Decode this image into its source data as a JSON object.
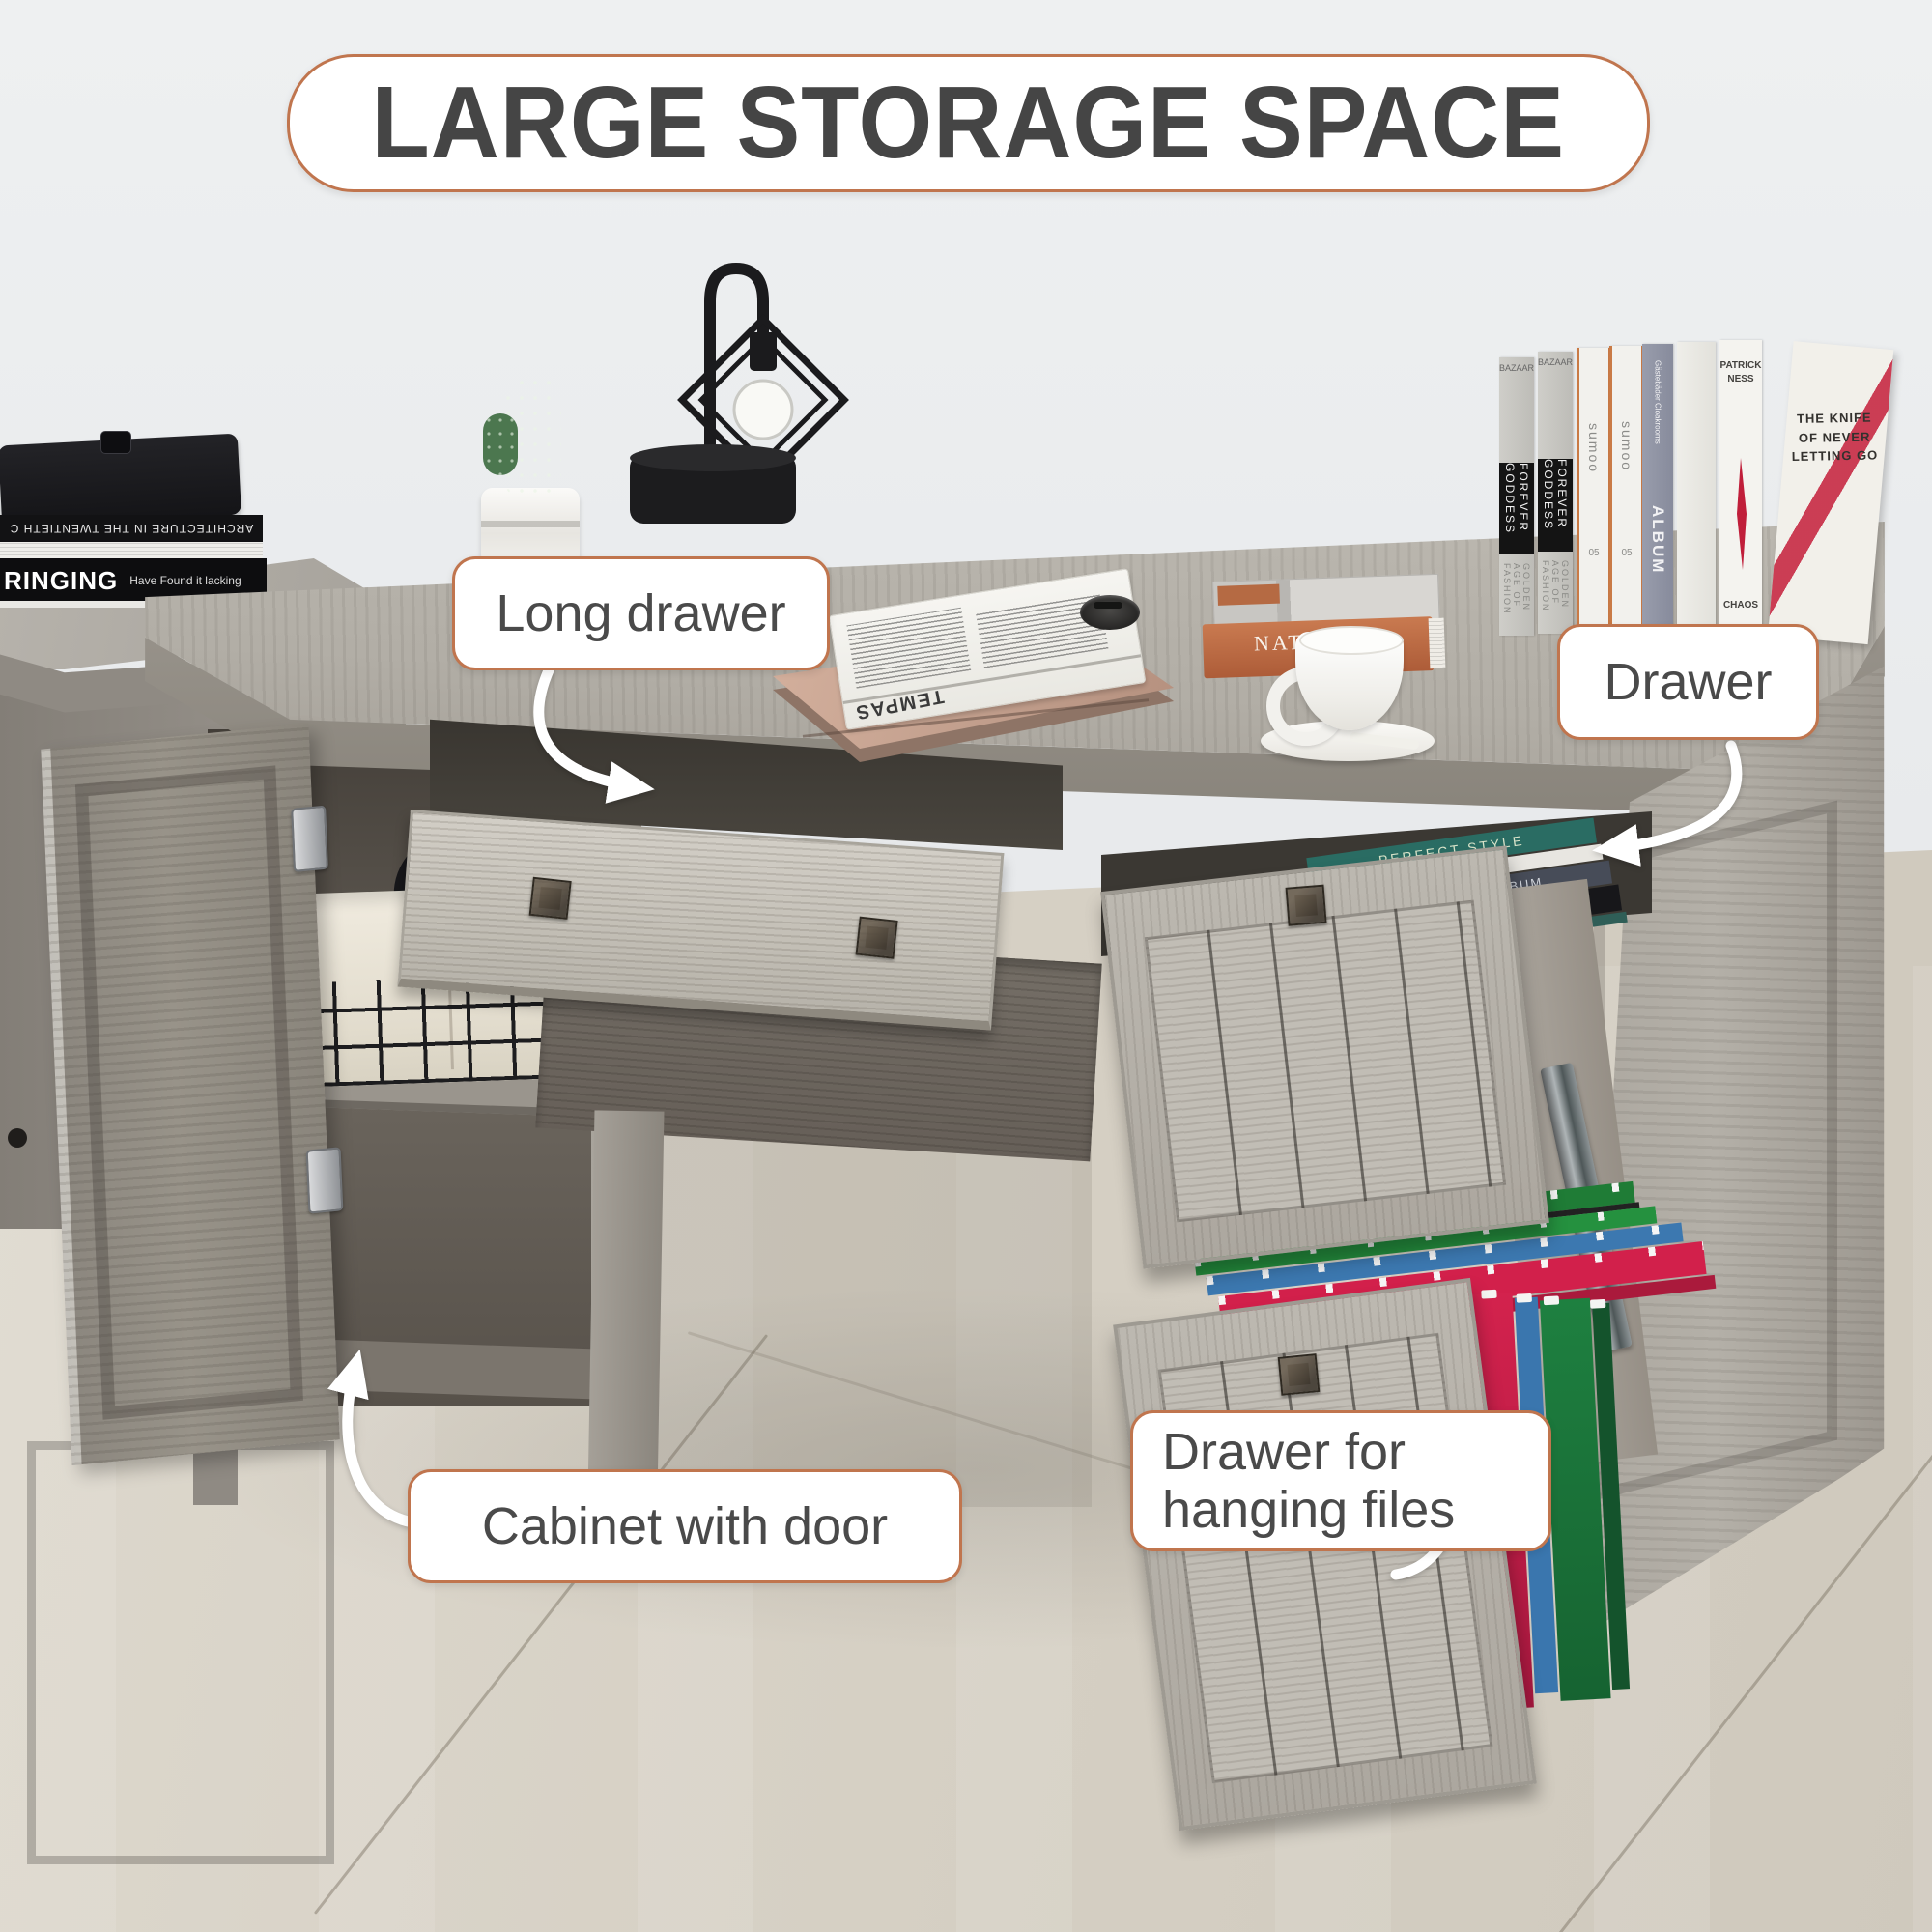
{
  "colors": {
    "accent": "#c0754e",
    "label-text": "#4a4a4a",
    "title-text": "#454545",
    "wall": "#e7e9ea",
    "floor": "#d8d2c7",
    "wood-top": "#aaa59d",
    "wood-front": "#c9c4bb",
    "wood-door": "#96918a",
    "wood-dark": "#564f48",
    "file-green": "#1f7c36",
    "file-blue": "#3c78b0",
    "file-red": "#d2204b",
    "laptop": "#c5a08e",
    "book-orange": "#bf6a45"
  },
  "title": "LARGE STORAGE SPACE",
  "callouts": {
    "long_drawer": "Long drawer",
    "drawer": "Drawer",
    "cabinet": "Cabinet with door",
    "hanging_files": "Drawer for hanging files"
  },
  "books": {
    "left_stack": {
      "architecture": "ARCHITECTURE IN THE TWENTIETH C",
      "ringing": "RINGING",
      "ringing_sub": "Have Found it lacking"
    },
    "shelf_row": [
      {
        "top": "BAZAAR",
        "spine": "FOREVER GODDESS",
        "bottom": "GOLDEN AGE OF FASHION"
      },
      {
        "top": "BAZAAR",
        "spine": "FOREVER GODDESS",
        "bottom": "GOLDEN AGE OF FASHION"
      },
      {
        "spine": "sumoo",
        "num": "05"
      },
      {
        "spine": "sumoo",
        "num": "05"
      },
      {
        "top": "Gästebäder Cloakrooms",
        "spine": "ALBUM"
      },
      {
        "author": "PATRICK NESS",
        "spine": "CHAOS"
      },
      {
        "cover": "THE KNIFE OF NEVER LETTING GO"
      }
    ],
    "drawer_books": [
      "PERFECT STYLE",
      "MERCHANTS ALBUM",
      "BRINGING"
    ],
    "desk_book": {
      "title": "NATHALIE",
      "sub": "schwe"
    },
    "newspaper": "TEMPAS"
  }
}
